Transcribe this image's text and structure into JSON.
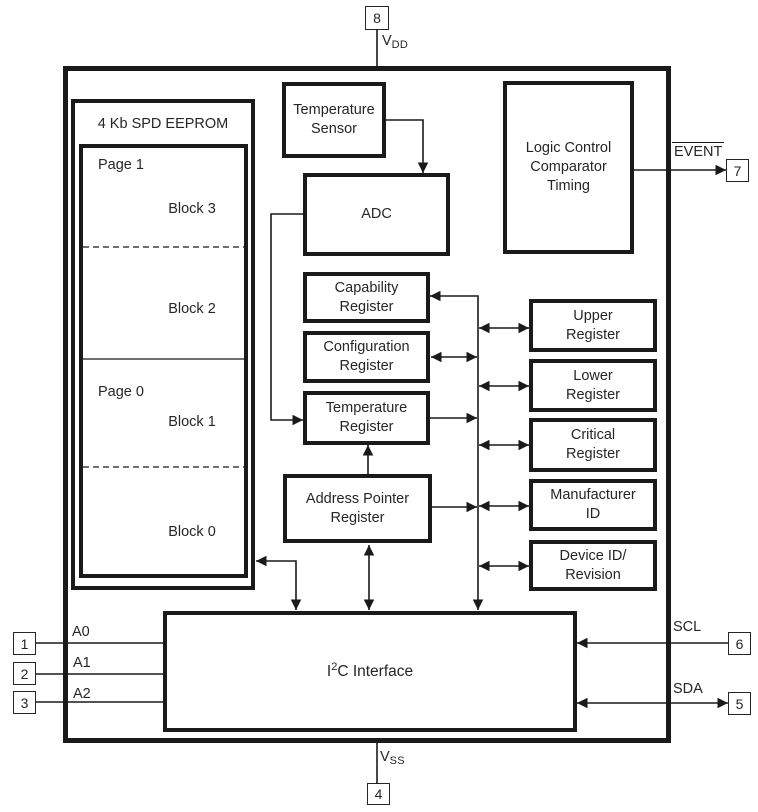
{
  "colors": {
    "line": "#1a1a1a",
    "text": "#262626",
    "background": "#ffffff"
  },
  "eeprom": {
    "title": "4 Kb SPD EEPROM",
    "page1_label": "Page 1",
    "block3": "Block 3",
    "block2": "Block 2",
    "page0_label": "Page 0",
    "block1": "Block 1",
    "block0": "Block 0"
  },
  "blocks": {
    "temperature_sensor": "Temperature\nSensor",
    "adc": "ADC",
    "logic_control": "Logic Control\nComparator\nTiming",
    "capability_register": "Capability\nRegister",
    "configuration_register": "Configuration\nRegister",
    "temperature_register": "Temperature\nRegister",
    "address_pointer_register": "Address Pointer\nRegister",
    "upper_register": "Upper\nRegister",
    "lower_register": "Lower\nRegister",
    "critical_register": "Critical\nRegister",
    "manufacturer_id": "Manufacturer\nID",
    "device_id_revision": "Device ID/\nRevision",
    "i2c_interface": {
      "base": "I",
      "sup": "2",
      "rest": "C Interface"
    }
  },
  "pins": {
    "pin1": {
      "number": "1",
      "label": "A0"
    },
    "pin2": {
      "number": "2",
      "label": "A1"
    },
    "pin3": {
      "number": "3",
      "label": "A2"
    },
    "pin4": {
      "number": "4",
      "label_base": "V",
      "label_sub": "SS"
    },
    "pin5": {
      "number": "5",
      "label": "SDA"
    },
    "pin6": {
      "number": "6",
      "label": "SCL"
    },
    "pin7": {
      "number": "7",
      "label": "EVENT"
    },
    "pin8": {
      "number": "8",
      "label_base": "V",
      "label_sub": "DD"
    }
  }
}
